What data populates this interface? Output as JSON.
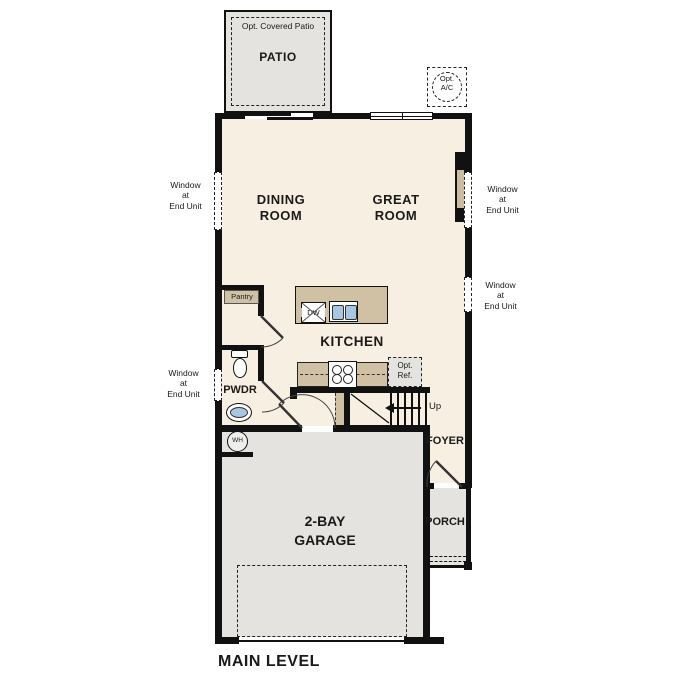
{
  "title": {
    "main_level": "MAIN LEVEL"
  },
  "colors": {
    "floor_cream": "#f7efe1",
    "outdoor_grey": "#e4e3e0",
    "cabinet_tan": "#d0c1a4",
    "sink_blue": "#a9c7e3",
    "wall_black": "#111111"
  },
  "rooms": {
    "patio": "PATIO",
    "opt_covered_patio": "Opt. Covered Patio",
    "dining": "DINING\nROOM",
    "great": "GREAT\nROOM",
    "kitchen": "KITCHEN",
    "pantry": "Pantry",
    "pwdr": "PWDR",
    "foyer": "FOYER",
    "porch": "PORCH",
    "garage": "2-BAY\nGARAGE"
  },
  "fixtures": {
    "dw": "DW",
    "wh": "WH",
    "opt_ac": "Opt.\nA/C",
    "opt_ref": "Opt.\nRef.",
    "up": "Up"
  },
  "notes": {
    "window_end_unit": "Window\nat\nEnd Unit"
  }
}
